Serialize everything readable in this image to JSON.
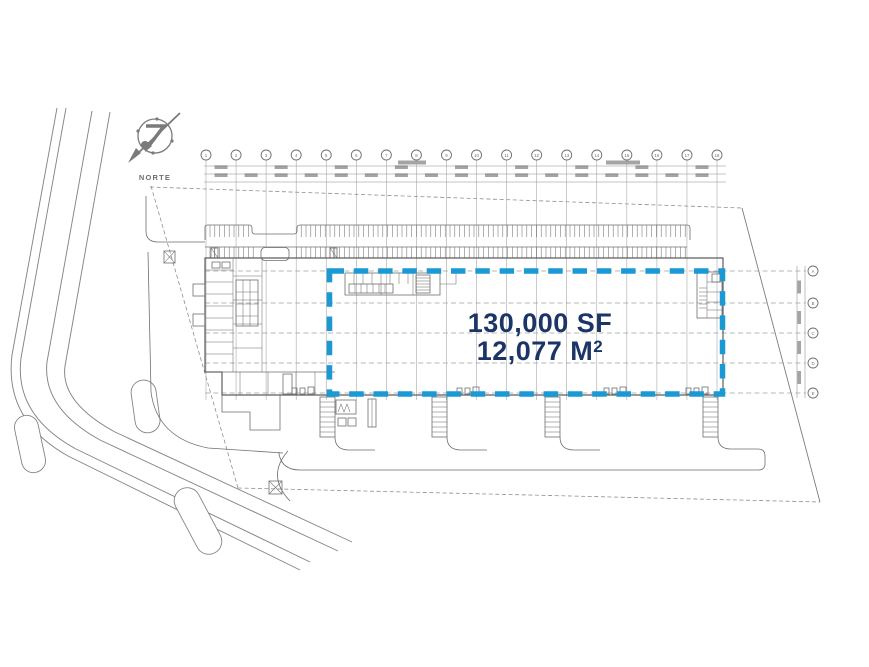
{
  "plan": {
    "compass_label": "NORTE",
    "compass_icon": "compass-north-icon",
    "highlight": {
      "area_sf": "130,000 SF",
      "area_m2": "12,077 M",
      "area_m2_sup": "2"
    },
    "grid": {
      "columns": [
        "1",
        "2",
        "3",
        "4",
        "5",
        "6",
        "7",
        "8",
        "9",
        "10",
        "11",
        "12",
        "13",
        "14",
        "15",
        "16",
        "17",
        "18"
      ],
      "rows": [
        "A",
        "B",
        "C",
        "D",
        "E"
      ]
    },
    "colors": {
      "line": "#6f6f6f",
      "line_light": "#a0a0a0",
      "boundary": "#9b8b81",
      "navy": "#1c3566",
      "blue": "#1b99d5"
    }
  }
}
